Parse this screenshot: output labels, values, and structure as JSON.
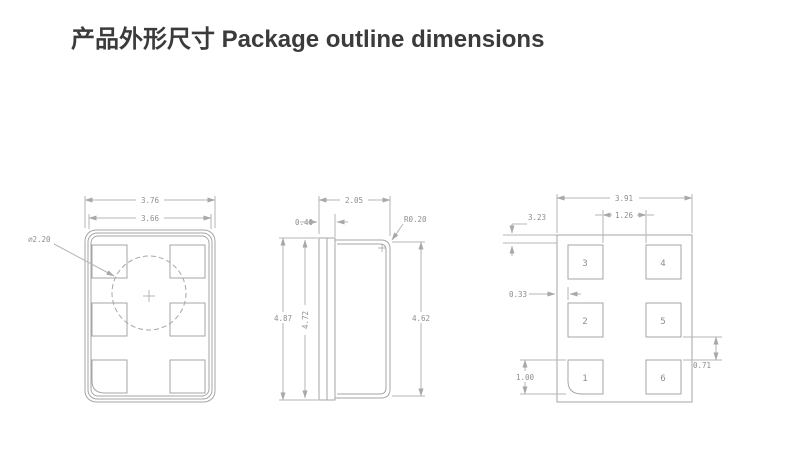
{
  "title": "产品外形尺寸 Package outline dimensions",
  "colors": {
    "background": "#ffffff",
    "title_text": "#3b3b3b",
    "drawing_lines": "#a6a6a6",
    "dimension_lines": "#b5b5b5",
    "dimension_text": "#8d8d8d"
  },
  "drawing": {
    "top_view": {
      "dim_outer_width": "3.76",
      "dim_inner_width": "3.66",
      "dim_circle_diameter": "∅2.20"
    },
    "side_view": {
      "dim_body_width": "2.05",
      "dim_lip_width": "0.40",
      "dim_corner_radius": "R0.20",
      "dim_overall_height": "4.87",
      "dim_inner_height": "4.72",
      "dim_lid_height": "4.62"
    },
    "land_pattern": {
      "dim_overall_width": "3.91",
      "dim_pad_gap_x": "1.26",
      "dim_top_offset": "3.23",
      "dim_edge_offset": "0.33",
      "dim_pad_height": "1.00",
      "dim_pad_gap_y": "0.71",
      "pads": [
        "3",
        "4",
        "2",
        "5",
        "1",
        "6"
      ]
    }
  }
}
